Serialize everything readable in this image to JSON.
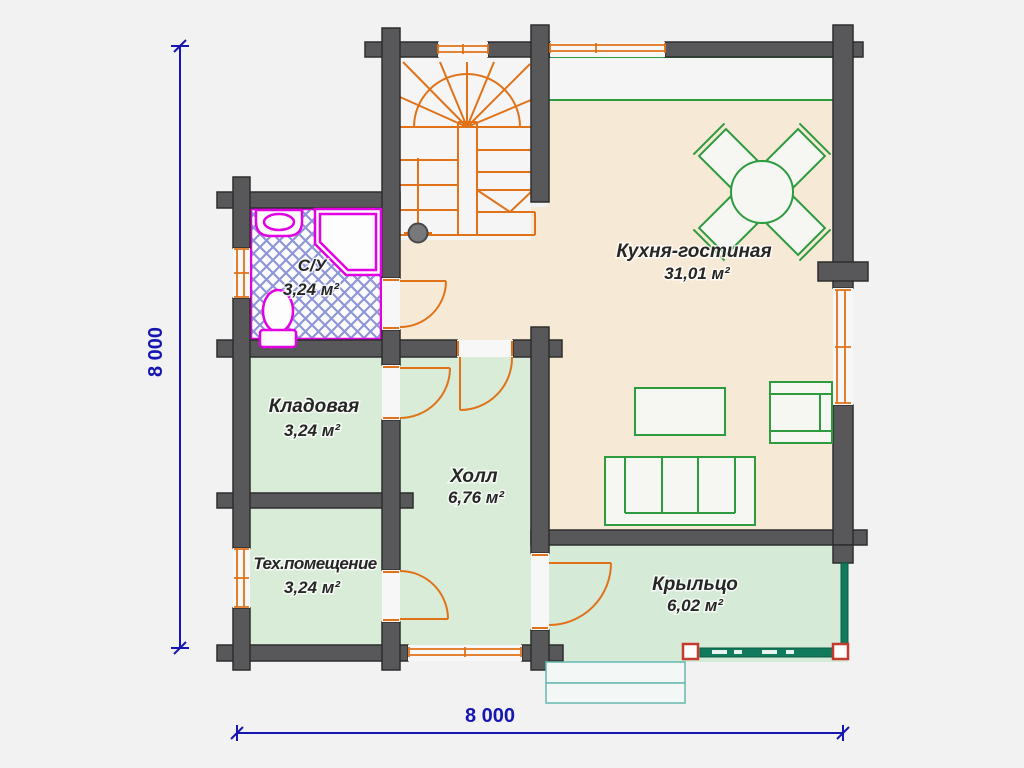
{
  "plan": {
    "rooms": [
      {
        "name": "Кухня-гостиная",
        "area": "31,01 м²"
      },
      {
        "name": "С/У",
        "area": "3,24 м²"
      },
      {
        "name": "Кладовая",
        "area": "3,24 м²"
      },
      {
        "name": "Холл",
        "area": "6,76 м²"
      },
      {
        "name": "Тех.помещение",
        "area": "3,24 м²"
      },
      {
        "name": "Крыльцо",
        "area": "6,02 м²"
      }
    ],
    "dimensions": {
      "left": "8 000",
      "bottom": "8 000"
    },
    "colors": {
      "wall": "#58585a",
      "kitchen_floor": "#f6e9d5",
      "room_floor": "#d8ecd8",
      "porch_floor": "#d6ead8",
      "stair_floor": "#f5f5f5",
      "accent_orange": "#e0731a",
      "fixture_magenta": "#e300e3",
      "furniture_green": "#2e9b3e",
      "railing_green": "#127a5c",
      "dimension_blue": "#1616b2",
      "hatch_blue": "#8f96d8"
    }
  }
}
